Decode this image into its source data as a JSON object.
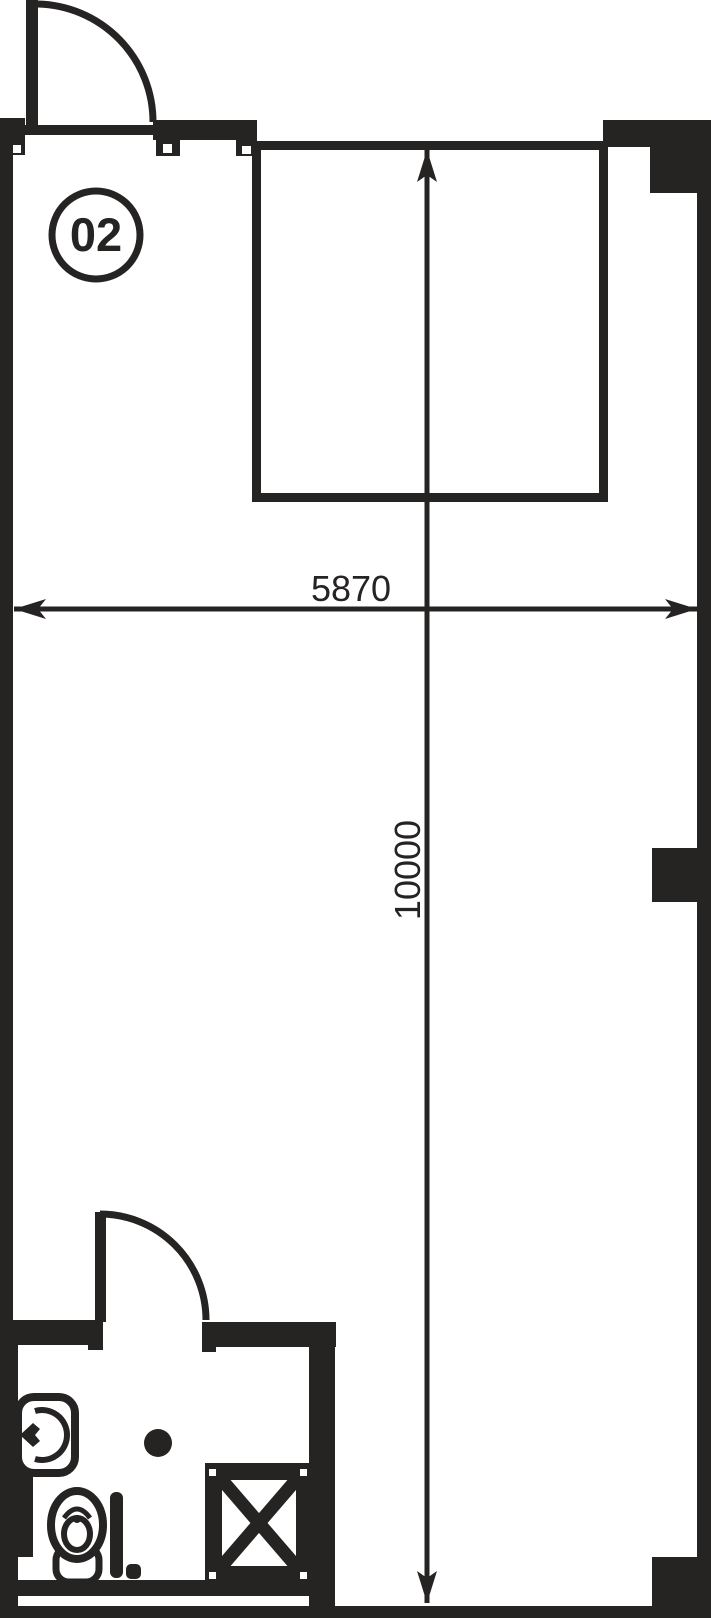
{
  "page": {
    "background": "#ffffff"
  },
  "colors": {
    "ink": "#262323",
    "paper": "#ffffff"
  },
  "unit": {
    "number": "02"
  },
  "dimensions": {
    "width": "5870",
    "height": "10000"
  },
  "symbols": {
    "entry_door": "door-swing-quarter-arc",
    "bathroom_door": "door-swing-quarter-arc",
    "toilet": "toilet-top-view",
    "wash_basin": "wall-hung-basin",
    "floor_drain": "round-drain",
    "grab_bar": "vertical-bar",
    "service_shaft": "crossed-box-shaft"
  }
}
